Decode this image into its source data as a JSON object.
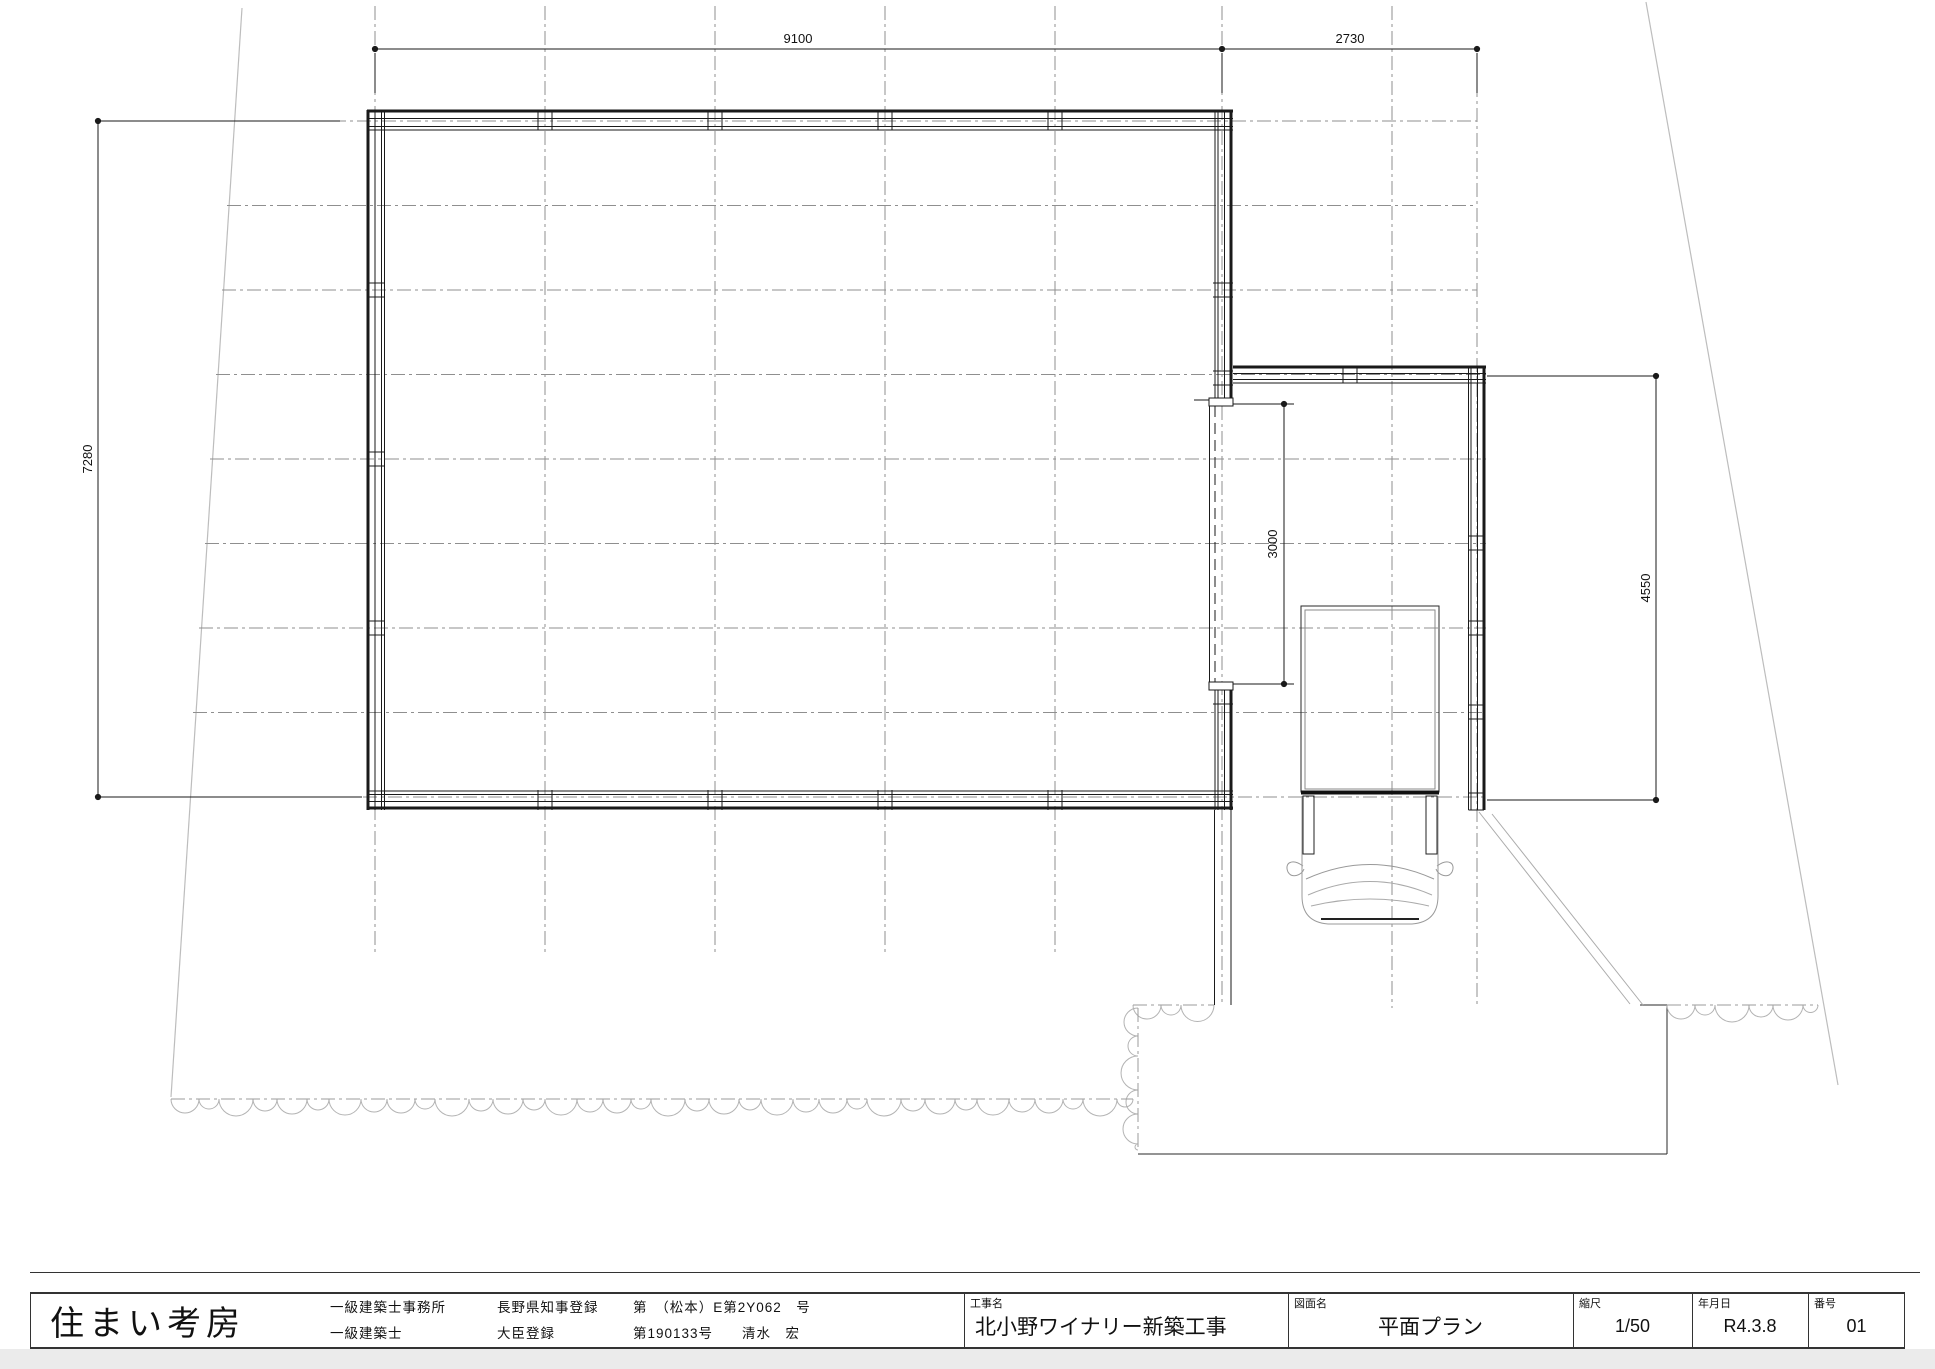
{
  "dimensions": {
    "top_width": "9100",
    "top_right_width": "2730",
    "left_height": "7280",
    "opening_height": "3000",
    "right_height": "4550"
  },
  "title_block": {
    "company": "住まい考房",
    "license_rows": [
      {
        "col1": "一級建築士事務所",
        "col2": "長野県知事登録",
        "col3": "第　（松本）E第2Y062　号"
      },
      {
        "col1": "一級建築士",
        "col2": "大臣登録",
        "col3": "第190133号　　清水　宏"
      }
    ],
    "project": {
      "label": "工事名",
      "value": "北小野ワイナリー新築工事"
    },
    "drawing": {
      "label": "図面名",
      "value": "平面プラン"
    },
    "scale": {
      "label": "縮尺",
      "value": "1/50"
    },
    "date": {
      "label": "年月日",
      "value": "R4.3.8"
    },
    "number": {
      "label": "番号",
      "value": "01"
    }
  }
}
